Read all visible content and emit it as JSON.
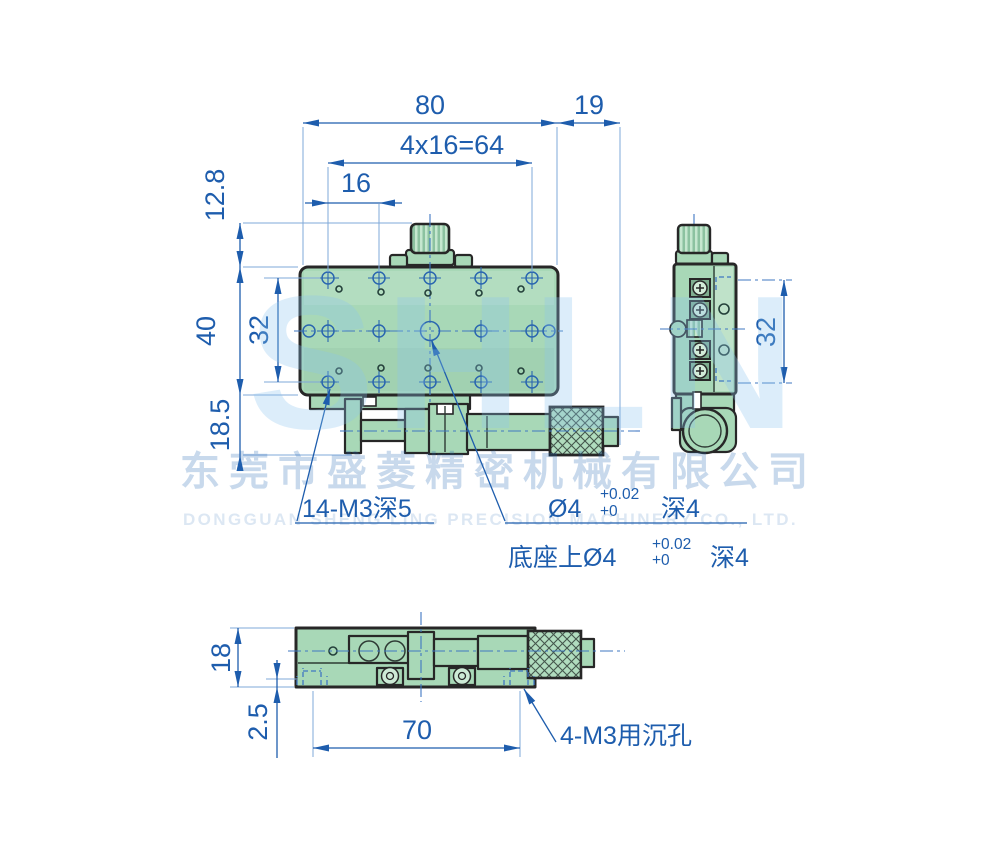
{
  "title": "XY linear stage engineering drawing",
  "colors": {
    "dimension_blue": "#1e5dad",
    "extension_blue": "#7fa8d9",
    "centerline_blue": "#3f77c2",
    "outline_dark": "#272727",
    "body_green": "#a8d8b7",
    "watermark_blue": "#c7ddf0"
  },
  "dims": {
    "top80": "80",
    "top19": "19",
    "row64": "4x16=64",
    "row16": "16",
    "left128": "12.8",
    "left40": "40",
    "left32": "32",
    "left185": "18.5",
    "side32": "32",
    "bottom18": "18",
    "bottom25": "2.5",
    "bottom70": "70"
  },
  "annotations": {
    "thread_holes": "14-M3深5",
    "center_hole_prefix": "Ø4",
    "center_hole_tol_upper": "+0.02",
    "center_hole_tol_lower": "+0",
    "center_hole_suffix": "深4",
    "base_hole_prefix": "底座上Ø4",
    "base_hole_tol_upper": "+0.02",
    "base_hole_tol_lower": "+0",
    "base_hole_suffix": "深4",
    "counterbore": "4-M3用沉孔"
  },
  "watermark": {
    "brand_letters": "SHLN",
    "company_cn": "东莞市盛菱精密机械有限公司",
    "company_en": "DONGGUAN SHENG LING PRECISION MACHINERY CO., LTD."
  }
}
